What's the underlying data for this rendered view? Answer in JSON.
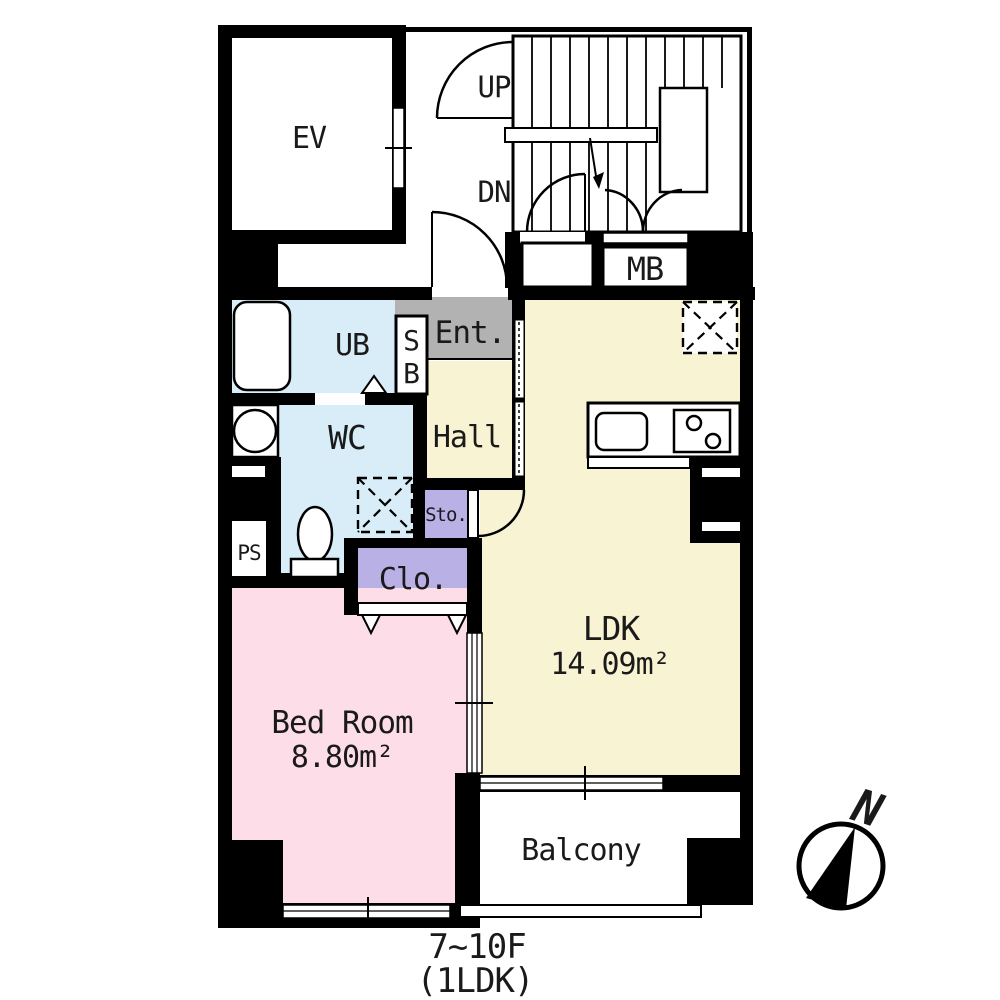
{
  "colors": {
    "wall": "#000000",
    "bath_toilet_blue": "#d8edf7",
    "hall_ldk_yellow": "#f8f3d2",
    "entrance_gray": "#b2b2b2",
    "storage_purple": "#b9b0e6",
    "bedroom_pink": "#fcdde8"
  },
  "labels": {
    "ev": "EV",
    "up": "UP",
    "down": "DN",
    "meter_box": "MB",
    "unit_bath": "UB",
    "shoe_box_s": "S",
    "shoe_box_b": "B",
    "entrance": "Ent.",
    "hall": "Hall",
    "wc": "WC",
    "pipe_space": "PS",
    "storage": "Sto.",
    "closet": "Clo.",
    "ldk": "LDK",
    "ldk_area": "14.09m²",
    "bedroom": "Bed Room",
    "bedroom_area": "8.80m²",
    "balcony": "Balcony",
    "north": "N",
    "floor_range": "7~10F",
    "layout_type": "(1LDK)"
  }
}
